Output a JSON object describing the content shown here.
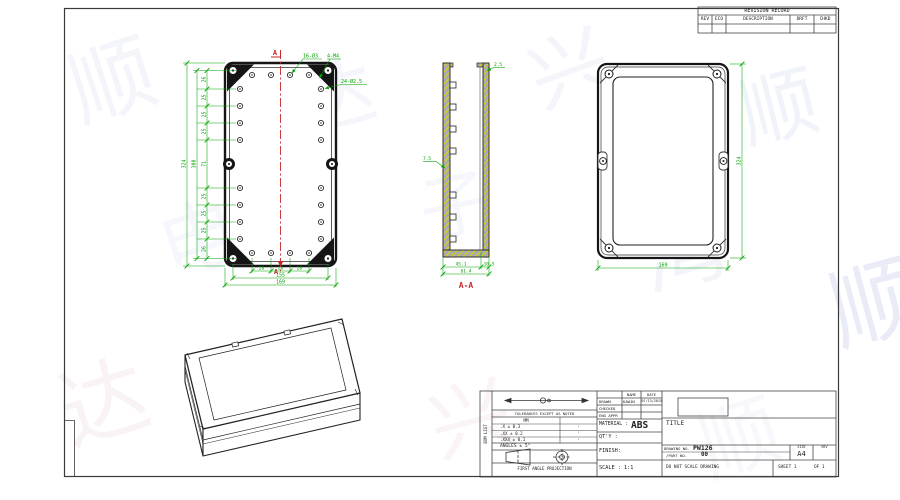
{
  "colors": {
    "dimension_green": "#00a400",
    "section_red": "#c62828",
    "hatch_yellow": "#d8d800",
    "linework": "#1a1a1a"
  },
  "watermarks": [
    {
      "char": "顺",
      "x": 70,
      "y": 40,
      "size": 85,
      "rot": -18,
      "color": "#8095d8",
      "op": 0.09
    },
    {
      "char": "达",
      "x": 300,
      "y": 60,
      "size": 75,
      "rot": -15,
      "color": "#8095d8",
      "op": 0.08
    },
    {
      "char": "兴",
      "x": 530,
      "y": 30,
      "size": 80,
      "rot": -20,
      "color": "#8095d8",
      "op": 0.09
    },
    {
      "char": "顺",
      "x": 740,
      "y": 70,
      "size": 78,
      "rot": -14,
      "color": "#8095d8",
      "op": 0.1
    },
    {
      "char": "电",
      "x": 160,
      "y": 200,
      "size": 80,
      "rot": -18,
      "color": "#8095d8",
      "op": 0.07
    },
    {
      "char": "子",
      "x": 420,
      "y": 170,
      "size": 72,
      "rot": -12,
      "color": "#8095d8",
      "op": 0.07
    },
    {
      "char": "湾",
      "x": 640,
      "y": 210,
      "size": 85,
      "rot": -16,
      "color": "#9fa8dc",
      "op": 0.12
    },
    {
      "char": "顺",
      "x": 830,
      "y": 260,
      "size": 90,
      "rot": -15,
      "color": "#7b8fd4",
      "op": 0.16
    },
    {
      "char": "达",
      "x": 60,
      "y": 360,
      "size": 88,
      "rot": -17,
      "color": "#d490a8",
      "op": 0.1
    },
    {
      "char": "兴",
      "x": 430,
      "y": 380,
      "size": 82,
      "rot": -15,
      "color": "#d490a8",
      "op": 0.09
    },
    {
      "char": "顺",
      "x": 700,
      "y": 400,
      "size": 80,
      "rot": -18,
      "color": "#9fa8dc",
      "op": 0.08
    }
  ],
  "revision_table": {
    "title": "REVISION RECORD",
    "columns": [
      "REV",
      "ECO",
      "DESCRIPTION",
      "DRFT",
      "CHKD"
    ]
  },
  "views": {
    "top_view": {
      "section_marker": "A",
      "annotations": {
        "top_holes": "16-Ø3",
        "corner_screws": "4-M4",
        "ring_holes": "24-Ø2.5"
      },
      "dims": {
        "left_segments": [
          "26",
          "25",
          "25",
          "25",
          "71",
          "25",
          "25",
          "25",
          "26"
        ],
        "inner_height": "300",
        "outer_height": "324",
        "bottom_segments": [
          "28",
          "28",
          "28"
        ],
        "bottom_span": "155",
        "bottom_overall": "169"
      }
    },
    "section_view": {
      "label": "A-A",
      "dims": {
        "lip": "2.5",
        "boss": "7.5",
        "base_left": "45.1",
        "base_right": "10.5",
        "overall": "61.4"
      }
    },
    "back_view": {
      "dims": {
        "height": "324",
        "width": "169"
      }
    }
  },
  "title_block": {
    "side_label": "BOM LIST",
    "tolerances": {
      "heading": "TOLERANCES EXCEPT AS NOTED",
      "unit": "MM",
      "rows": [
        ".X ± 0.3",
        ".XX ± 0.2",
        ".XXX ± 0.1"
      ],
      "secondary": [
        "·",
        "·",
        "·"
      ],
      "angles": "ANGLES ± 5°",
      "projection": "FIRST ANGLE PROJECTION"
    },
    "info": {
      "name_header": "NAME",
      "date_header": "DATE",
      "drawn_label": "DRAWN",
      "drawn_name": "KAWIN",
      "drawn_date": "07/13/2015",
      "checked_label": "CHECKED",
      "eng_appr_label": "ENG APPR",
      "material_label": "MATERIAL :",
      "material_value": "ABS",
      "qty_label": "QT'Y :",
      "finish_label": "FINISH:",
      "scale_label": "SCALE : 1:1"
    },
    "title_label": "TITLE",
    "drawing_no_label": "DRAWING NO.",
    "drawing_no": "PW126",
    "part_no_label": "/PART NO.",
    "part_no": "00",
    "size_label": "SIZE",
    "size_value": "A4",
    "rev_label": "REV",
    "do_not_scale": "DO NOT SCALE DRAWING",
    "sheet": "SHEET 1",
    "of": "OF 1"
  }
}
